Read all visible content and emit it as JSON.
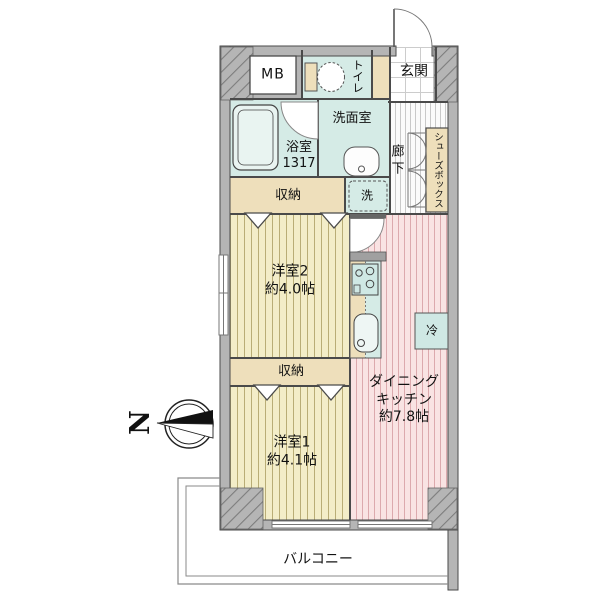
{
  "rooms": {
    "mb": {
      "label": "MB"
    },
    "toilet": {
      "label": "トイレ"
    },
    "entrance": {
      "label": "玄関"
    },
    "bathroom": {
      "label": "浴室\n1317"
    },
    "washroom": {
      "label": "洗面室"
    },
    "hallway": {
      "label": "廊下"
    },
    "shoe_box": {
      "label": "シューズボックス"
    },
    "storage_upper": {
      "label": "収納"
    },
    "laundry": {
      "label": "洗"
    },
    "western_room2": {
      "label": "洋室2\n約4.0帖"
    },
    "refrigerator": {
      "label": "冷"
    },
    "dining_kitchen": {
      "label": "ダイニング\nキッチン\n約7.8帖"
    },
    "storage_lower": {
      "label": "収納"
    },
    "western_room1": {
      "label": "洋室1\n約4.1帖"
    },
    "balcony": {
      "label": "バルコニー"
    }
  },
  "compass": {
    "label": "N"
  },
  "colors": {
    "wall": "#b5b5b5",
    "wet_room": "#d5ebe6",
    "closet": "#eedfbb",
    "room_floor": "#f3edc8",
    "room_stripe": "#b9ad76",
    "dk_floor": "#f9e3e3",
    "dk_stripe": "#dca9ad",
    "corridor_stripe": "#c9c9c9",
    "outline": "#4a4a4a"
  }
}
